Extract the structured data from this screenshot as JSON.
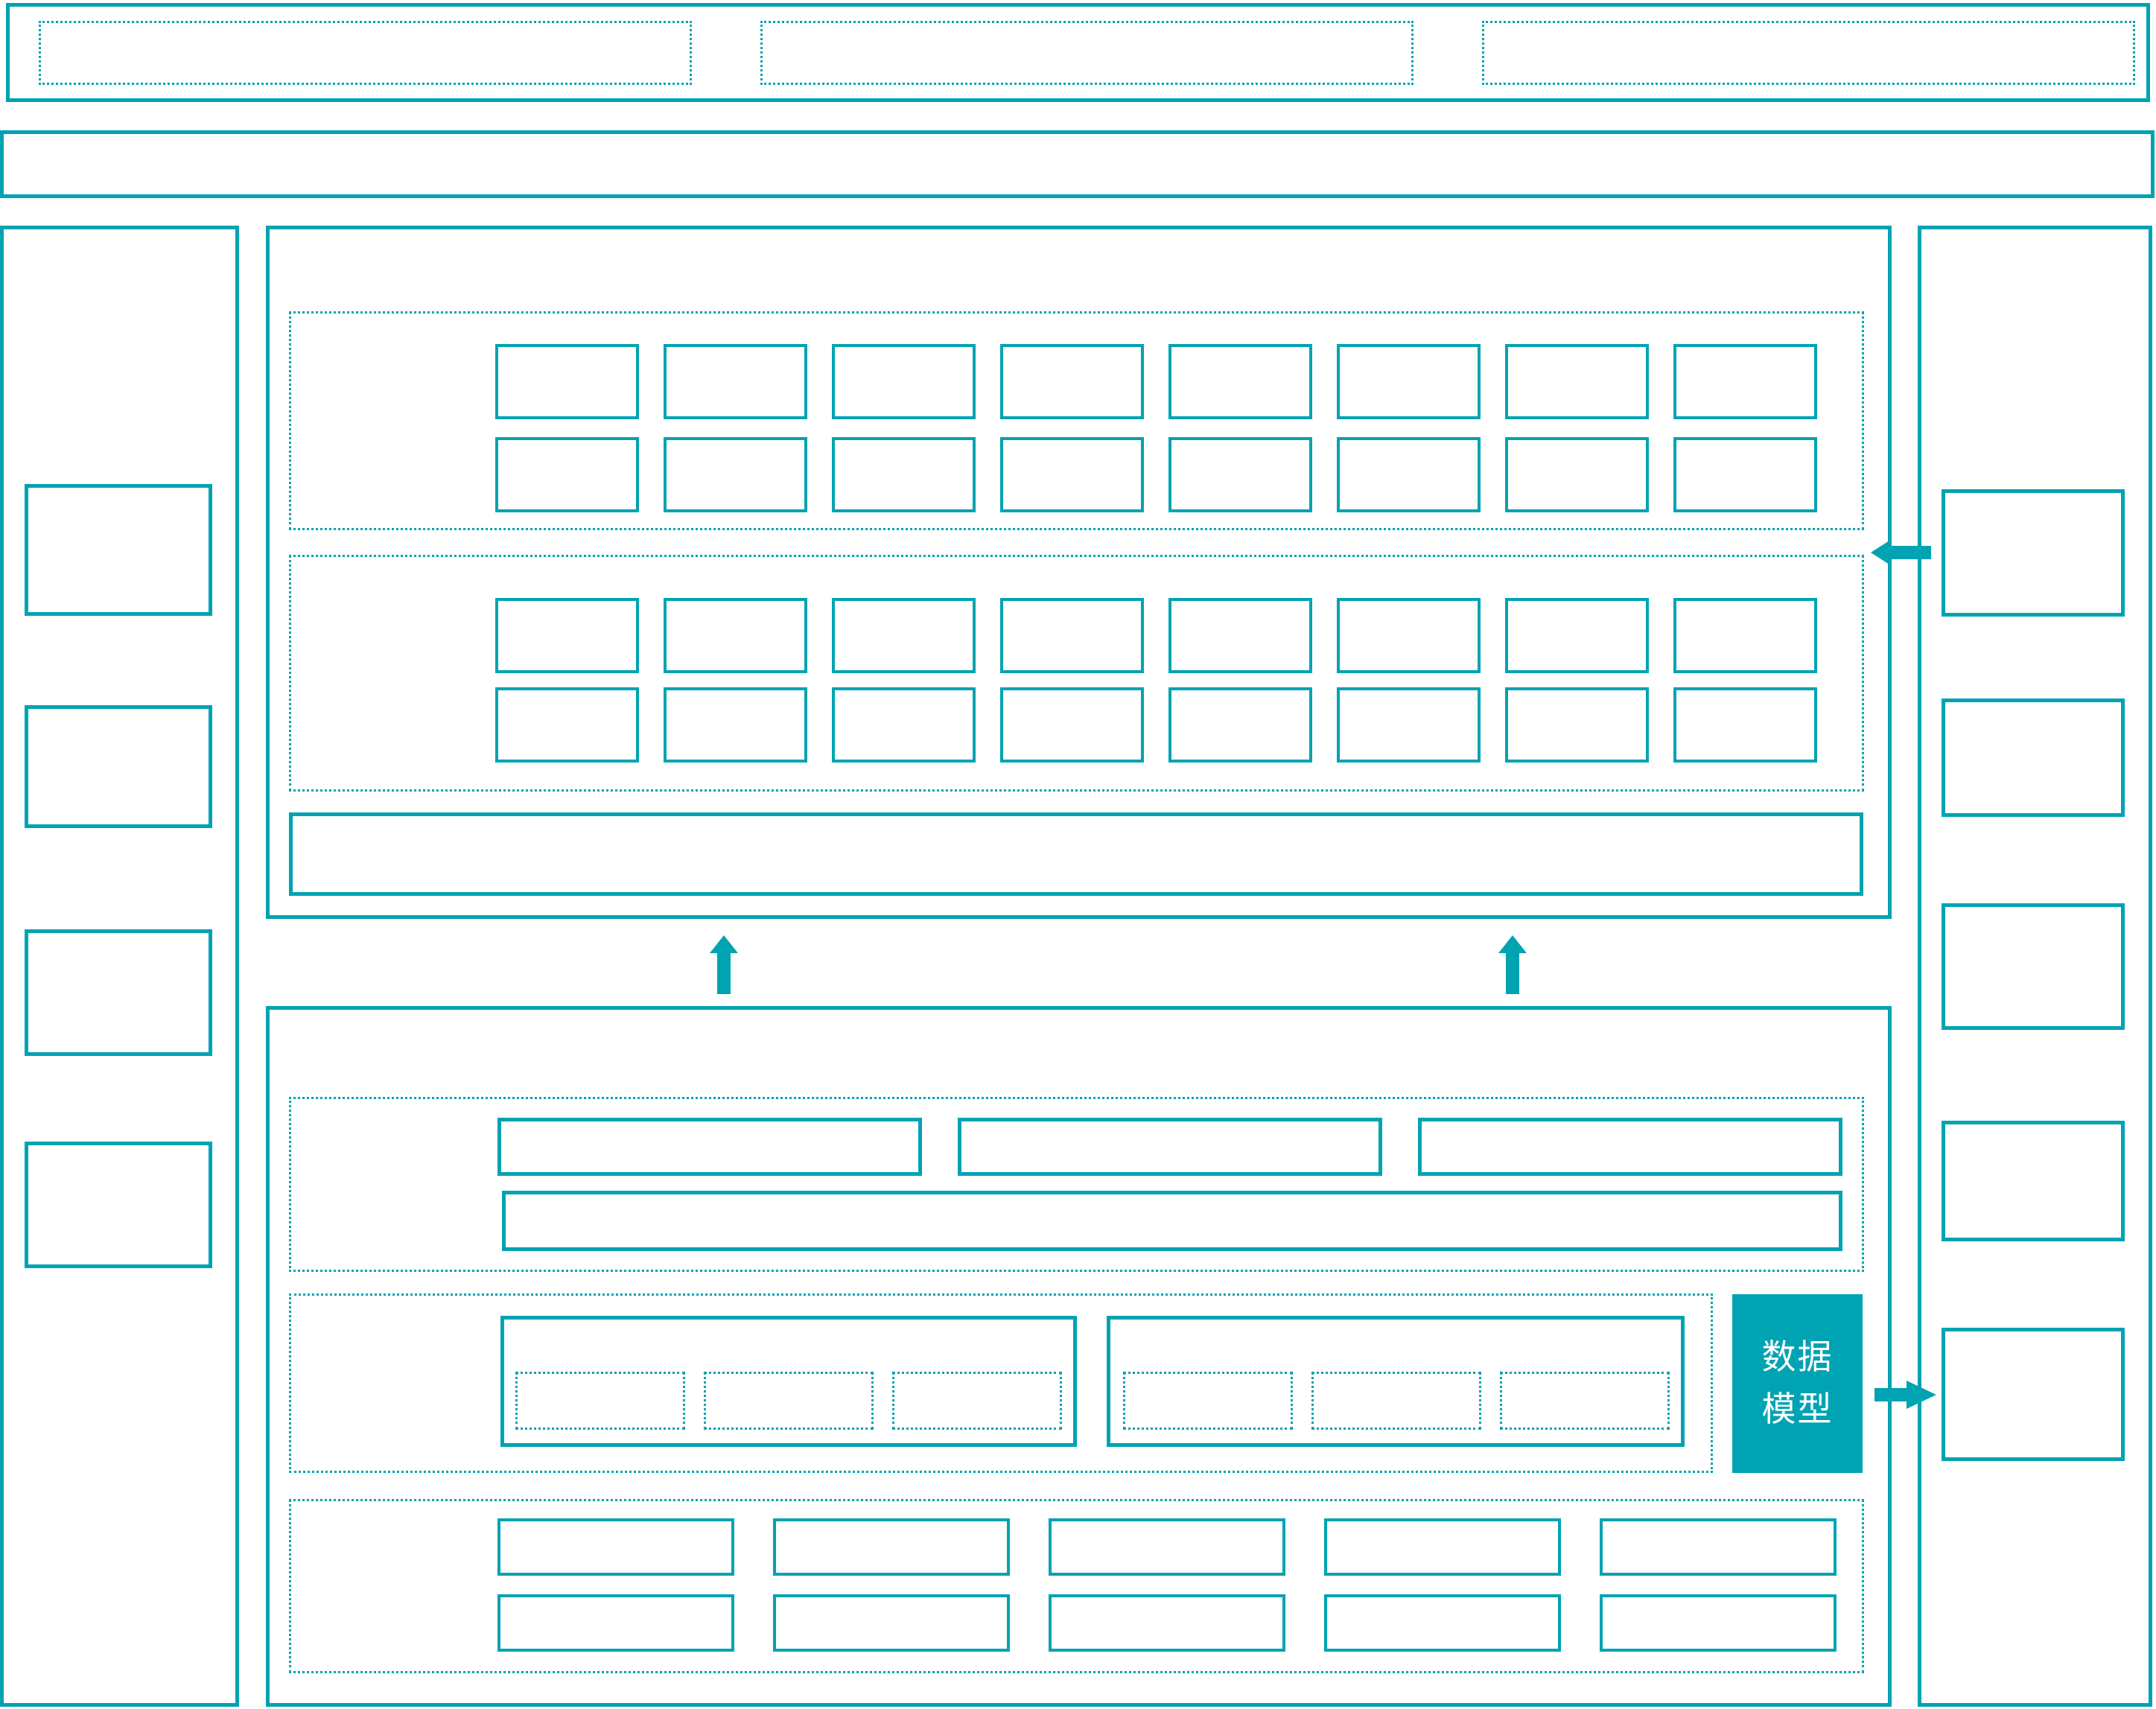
{
  "palette": {
    "teal": "#00a3b2",
    "background": "#ffffff",
    "data_model_text": "#ffffff"
  },
  "top_bar": {
    "slot_count": 3
  },
  "header_band": {},
  "left_sidebar": {
    "box_count": 4
  },
  "right_sidebar": {
    "box_count": 5
  },
  "upper_panel": {
    "layer_a": {
      "rows": 2,
      "cols": 8
    },
    "layer_b": {
      "rows": 2,
      "cols": 8
    },
    "bottom_bar": {}
  },
  "lower_panel": {
    "wide_row": {
      "box_count": 3
    },
    "full_bar": {},
    "module_groups": {
      "group_count": 2,
      "slots_per_group": 3
    },
    "data_model": {
      "label": "数据\n模型"
    },
    "bottom_grid": {
      "rows": 2,
      "cols": 5
    }
  },
  "arrows": {
    "up_connectors": 2,
    "into_upper_panel": 1,
    "from_data_model": 1
  }
}
